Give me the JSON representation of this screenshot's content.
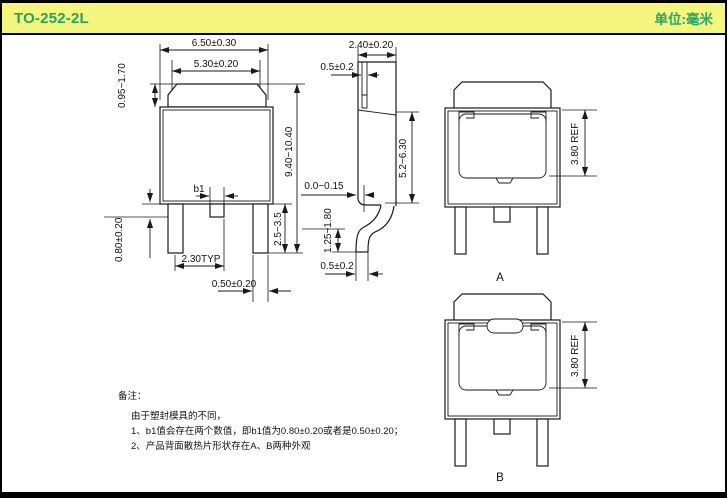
{
  "header": {
    "title": "TO-252-2L",
    "unit_label": "单位:毫米"
  },
  "colors": {
    "header_bg": "#f5f67e",
    "header_text": "#22a467",
    "line": "#1a1a1a",
    "frame": "#000000"
  },
  "front_view": {
    "dim_tab_width": "6.50±0.30",
    "dim_tab_top_width": "5.30±0.20",
    "dim_tab_height": "0.95~1.70",
    "dim_total_height": "9.40~10.40",
    "dim_b1": "b1",
    "dim_stub_length": "0.80±0.20",
    "dim_lead_pitch": "2.30TYP",
    "dim_lead_width": "0.50±0.20",
    "dim_lead_length": "2.5~3.5"
  },
  "side_view": {
    "dim_thickness": "2.40±0.20",
    "dim_tab_thickness": "0.5±0.2",
    "dim_body_height": "5.2~6.30",
    "dim_standoff": "0.0~0.15",
    "dim_foot_height": "1.25~1.80",
    "dim_lead_thickness": "0.5±0.2"
  },
  "view_a": {
    "label": "A",
    "dim_pad_height": "3.80 REF"
  },
  "view_b": {
    "label": "B",
    "dim_pad_height": "3.80 REF"
  },
  "notes": {
    "title": "备注：",
    "lines": [
      "由于塑封模具的不同，",
      "1、b1值会存在两个数值，即b1值为0.80±0.20或者是0.50±0.20；",
      "2、产品背面散热片形状存在A、B两种外观"
    ]
  }
}
